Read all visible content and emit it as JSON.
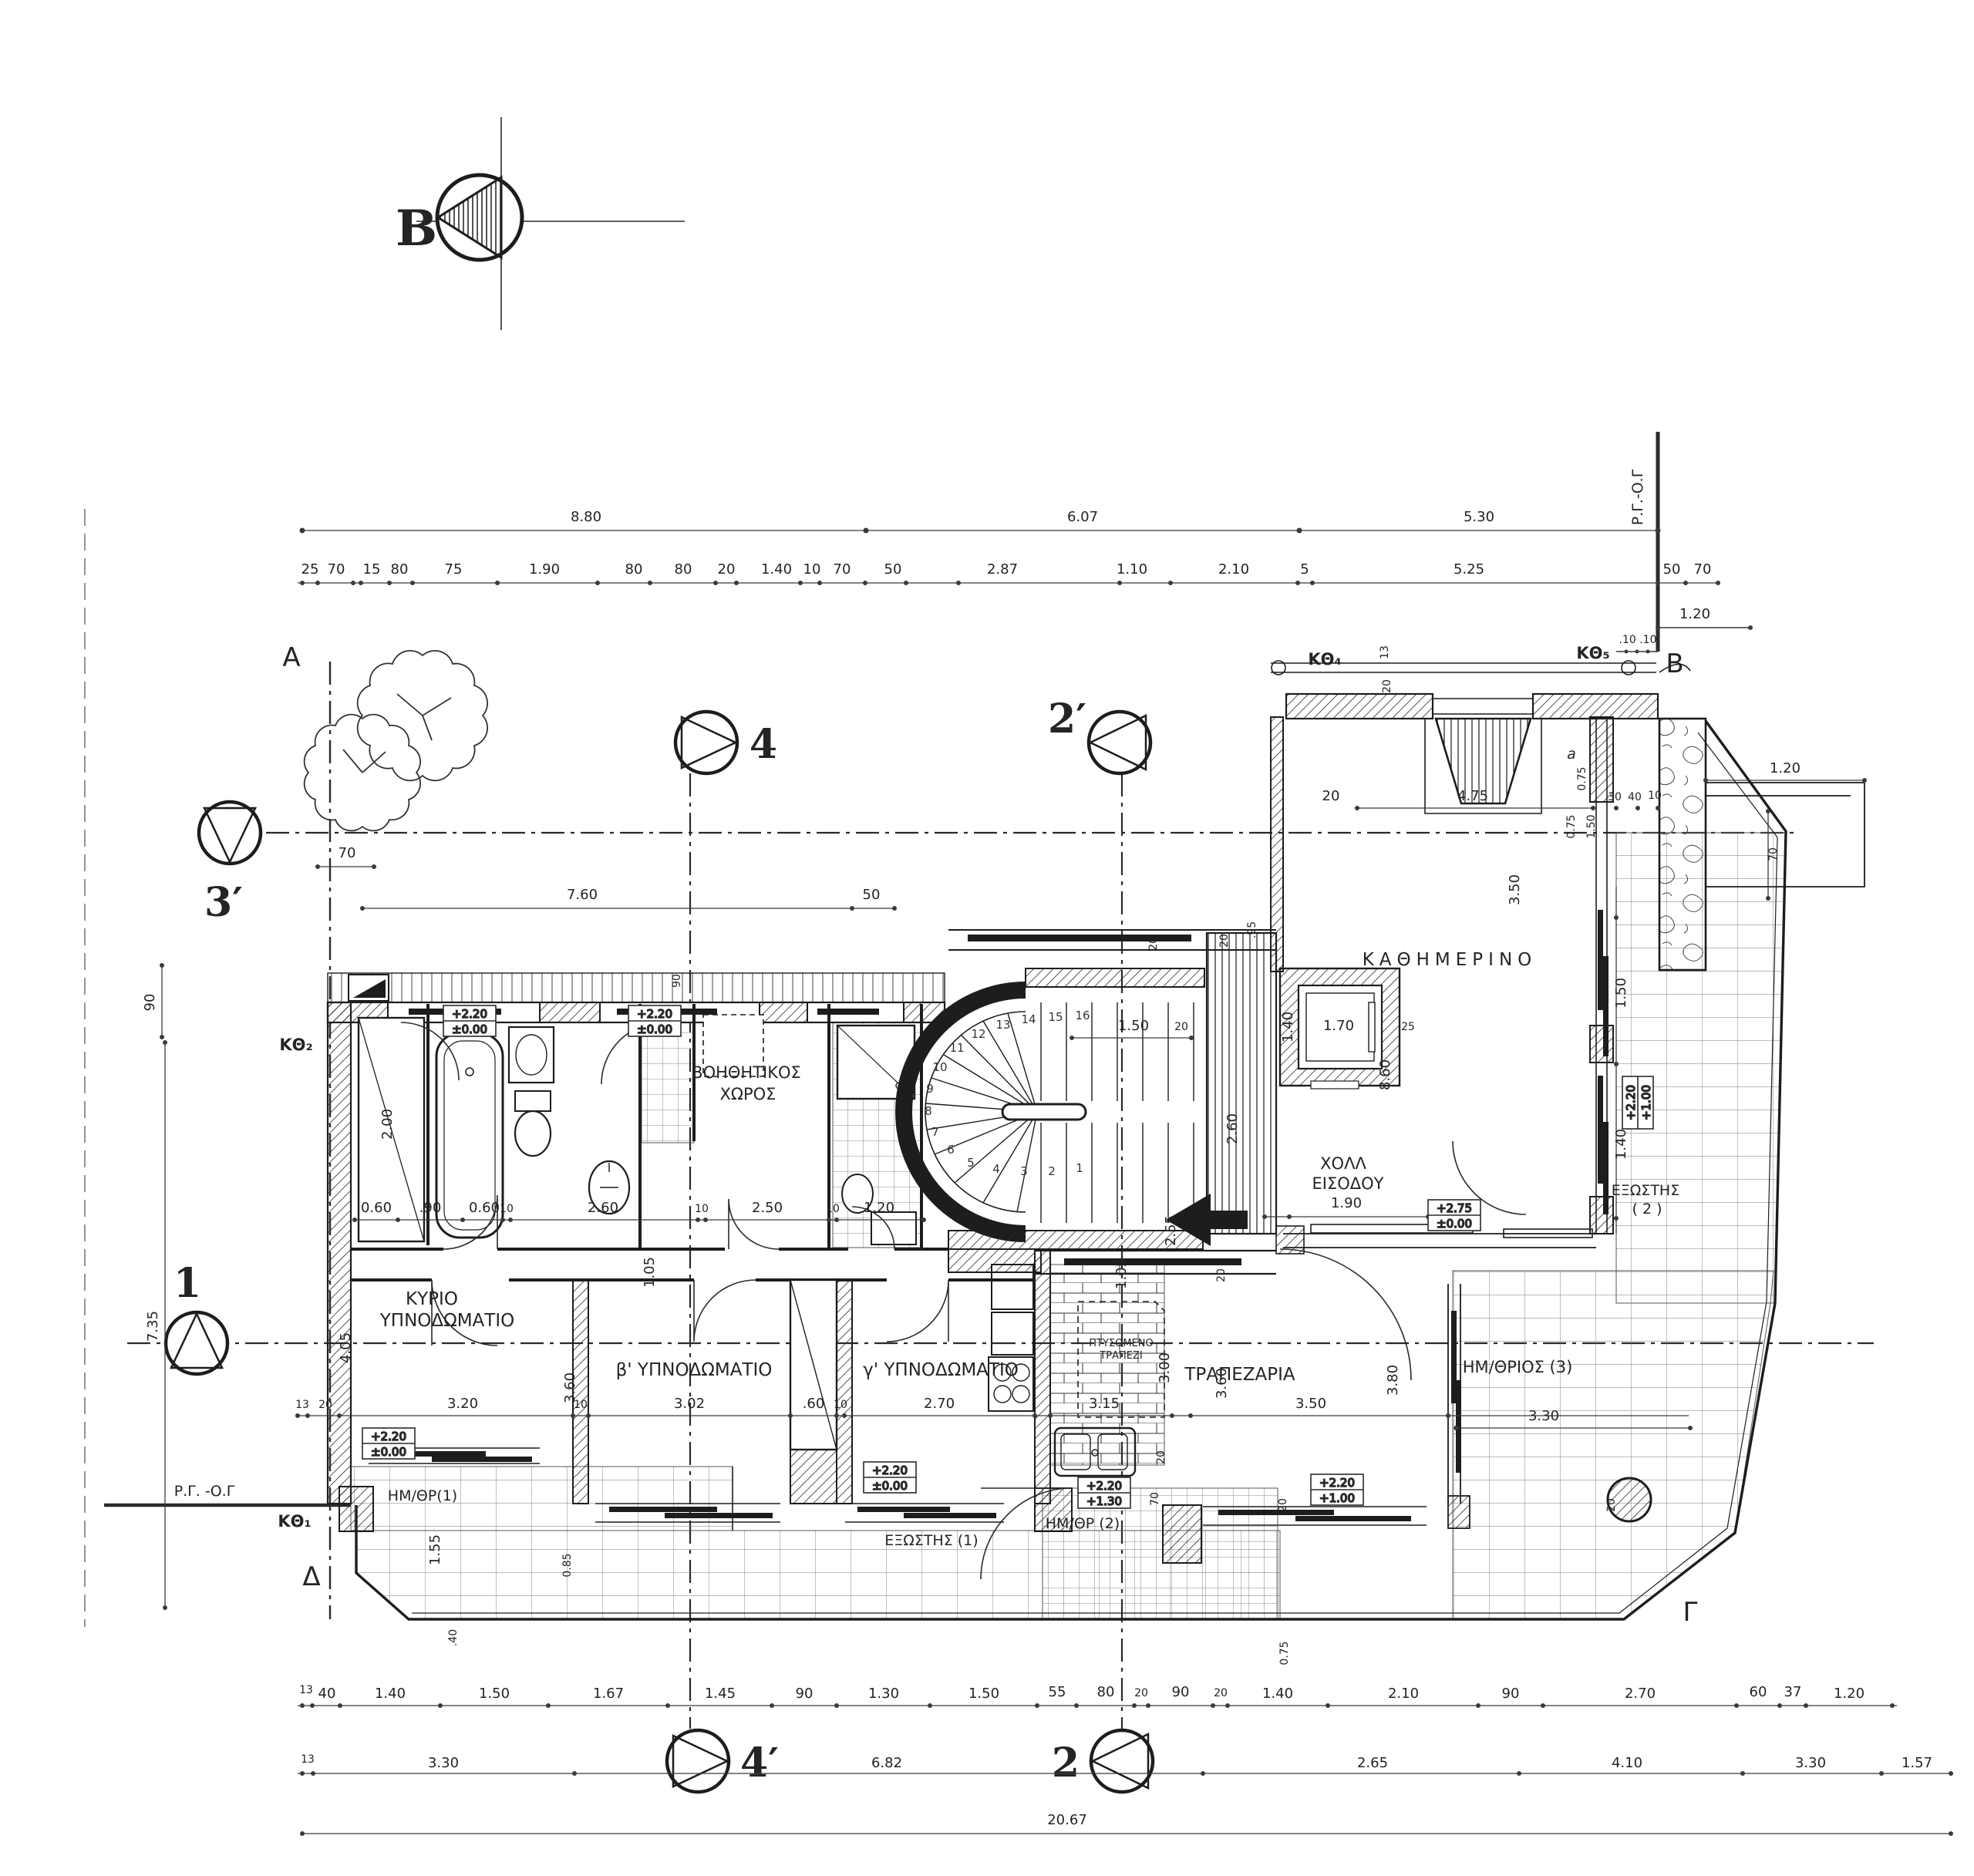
{
  "meta": {
    "ink": "#242424",
    "paper": "#ffffff",
    "thin": "#555555"
  },
  "section_markers": {
    "b_section": "B",
    "s4": "4",
    "s2p": "2′",
    "s3p": "3′",
    "s1": "1",
    "s4p": "4′",
    "s2": "2"
  },
  "grid_letters": {
    "a": "A",
    "b": "B",
    "gamma": "Γ",
    "delta": "Δ"
  },
  "window_labels": {
    "k1": "ΚΘ₁",
    "k2": "ΚΘ₂",
    "k4": "ΚΘ₄",
    "k5": "ΚΘ₅"
  },
  "boundary_labels": {
    "rg_right": "Ρ.Γ.-Ο.Γ",
    "rg_left": "Ρ.Γ. -Ο.Γ"
  },
  "rooms": {
    "kyrio1": "ΚΥΡΙΟ",
    "kyrio2": "ΥΠΝΟΔΩΜΑΤΙΟ",
    "b_bed": "β' ΥΠΝΟΔΩΜΑΤΙΟ",
    "g_bed": "γ' ΥΠΝΟΔΩΜΑΤΙΟ",
    "voith1": "ΒΟΗΘΗΤΙΚΟΣ",
    "voith2": "ΧΩΡΟΣ",
    "holl1": "ΧΟΛΛ",
    "holl2": "ΕΙΣΟΔΟΥ",
    "living": "ΚΑΘΗΜΕΡΙΝΟ",
    "dining": "ΤΡΑΠΕΖΑΡΙΑ",
    "imithrios3": "ΗΜ/ΘΡΙΟΣ (3)",
    "exostis1": "ΕΞΩΣΤΗΣ (1)",
    "exostis2a": "ΕΞΩΣΤΗΣ",
    "exostis2b": "( 2 )",
    "imithr1": "ΗΜ/ΘΡ(1)",
    "imithr2": "ΗΜ/ΘΡ (2)",
    "table1": "ΠΤΥΣΟΜΕΝΟ",
    "table2": "ΤΡΑΠΕΖΙ",
    "a_ref": "a"
  },
  "stair_steps": [
    "1",
    "2",
    "3",
    "4",
    "5",
    "6",
    "7",
    "8",
    "9",
    "10",
    "11",
    "12",
    "13",
    "14",
    "15",
    "16"
  ],
  "elevations": [
    {
      "top": "+2.20",
      "bottom": "±0.00"
    },
    {
      "top": "+2.20",
      "bottom": "±0.00"
    },
    {
      "top": "+2.20",
      "bottom": "±0.00"
    },
    {
      "top": "+2.20",
      "bottom": "±0.00"
    },
    {
      "top": "+2.20",
      "bottom": "+1.30"
    },
    {
      "top": "+2.20",
      "bottom": "+1.00"
    },
    {
      "top": "+2.75",
      "bottom": "±0.00"
    },
    {
      "top": "+2.20",
      "bottom": "+1.00"
    }
  ],
  "dims": {
    "top1": [
      "8.80",
      "6.07",
      "5.30"
    ],
    "top2": [
      "25",
      "70",
      "15",
      "80",
      "75",
      "1.90",
      "80",
      "80",
      "20",
      "1.40",
      "10",
      "70",
      "50",
      "2.87",
      "1.10",
      "2.10",
      "5",
      "5.25",
      "50",
      "70"
    ],
    "top3": [
      "1.20",
      ".10 .10",
      "13",
      "20",
      "1.20"
    ],
    "wall_top": [
      "20",
      "4.75",
      "30",
      "40",
      "10",
      "0.75",
      "0.75",
      "1.50",
      "70"
    ],
    "left": [
      "90",
      "7.35",
      "70",
      "7.60",
      "50"
    ],
    "bath": [
      "0.60",
      ".90",
      "0.60",
      "10",
      "2.60",
      "10",
      "2.50",
      "10",
      "1.20",
      "2.00",
      "90",
      "20",
      "1.05"
    ],
    "stair": [
      "20",
      "20",
      ".95",
      "1.50",
      "20",
      "1.40",
      "1.70",
      "25",
      "2.60",
      "1.90",
      "2.55",
      "1.05",
      "8.60",
      "3.50",
      "1.50",
      "1.40"
    ],
    "bedrooms": [
      "13",
      "20",
      "3.20",
      "10",
      "3.02",
      ".60",
      "10",
      "2.70",
      "4.05",
      "3.60",
      "30",
      "1.55",
      "0.85",
      ".40"
    ],
    "kitchen": [
      "3.15",
      "3.00",
      "3.60",
      "3.50",
      "3.80",
      "3.30",
      "20",
      "20",
      "70",
      "20",
      "20",
      "0.75"
    ],
    "bottom1": [
      "13",
      "40",
      "1.40",
      "1.50",
      "1.67",
      "1.45",
      "90",
      "1.30",
      "1.50",
      "55",
      "80",
      "20",
      "90",
      "20",
      "1.40",
      "2.10",
      "90",
      "2.70",
      "60",
      "37",
      "1.20"
    ],
    "bottom2": [
      "13",
      "3.30",
      "6.82",
      "2.65",
      "4.10",
      "3.30",
      "1.57"
    ],
    "total": "20.67"
  }
}
